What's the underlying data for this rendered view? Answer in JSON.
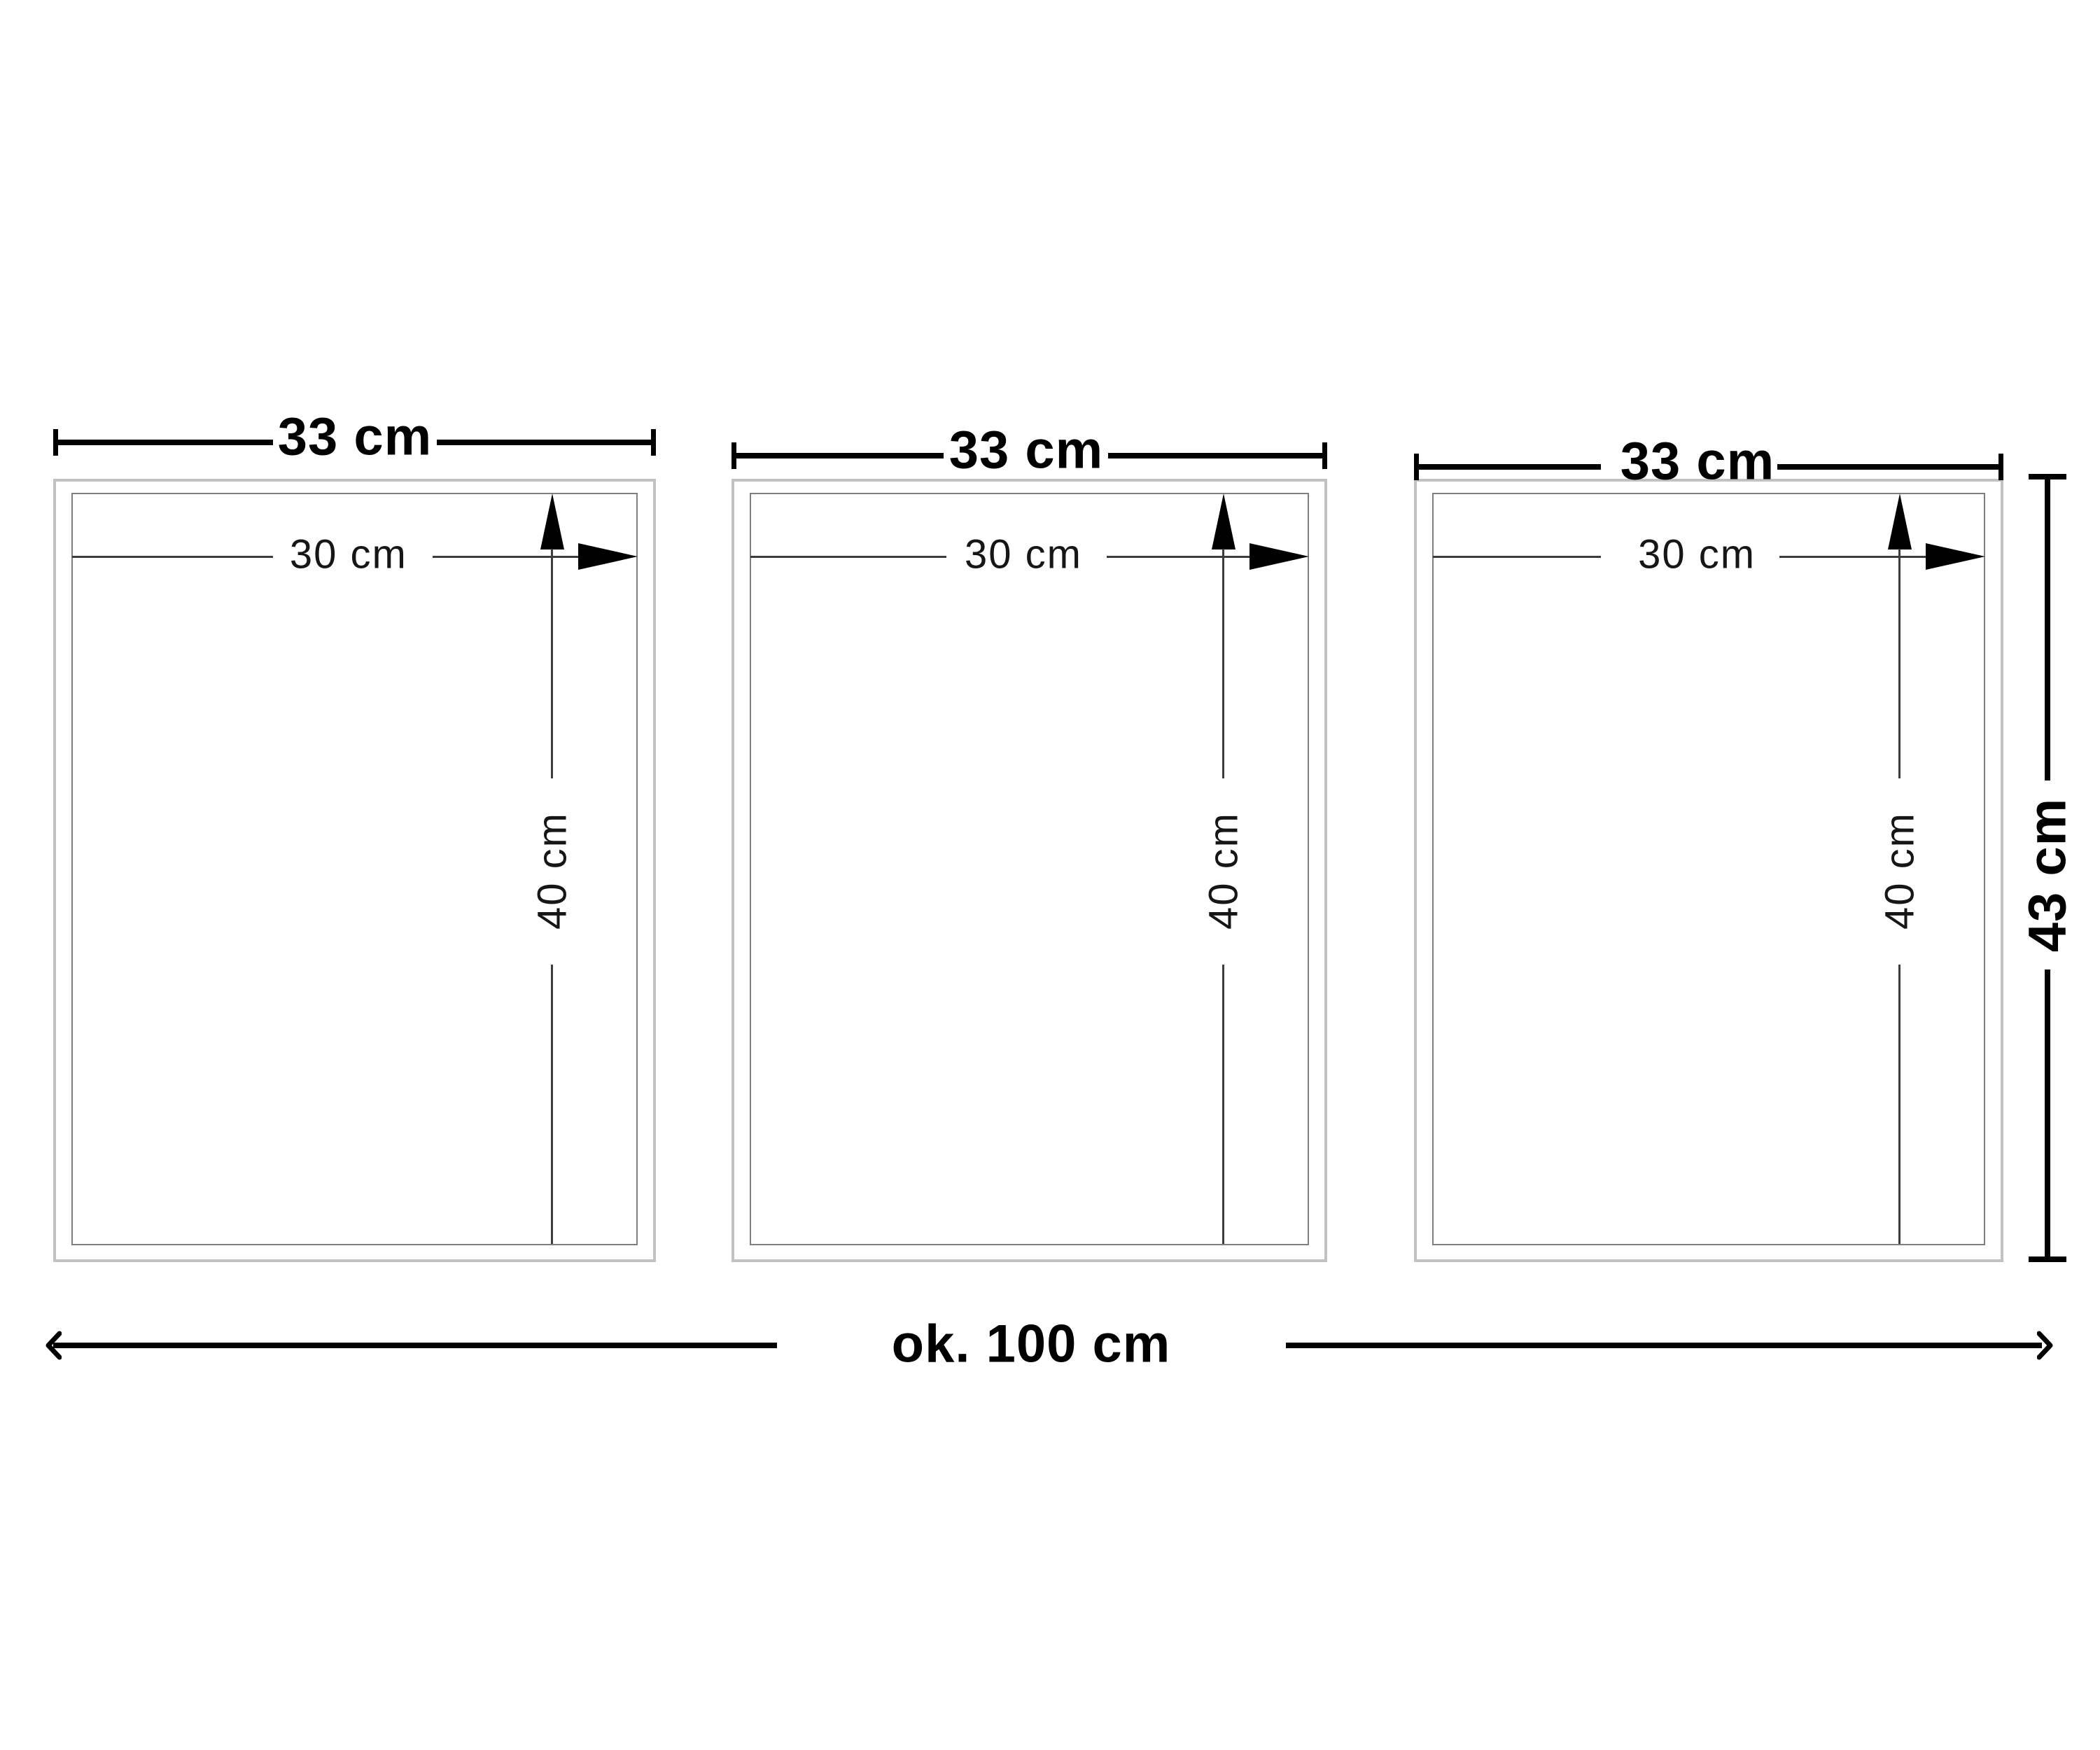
{
  "diagram": {
    "frames": [
      {
        "width_label": "33 cm",
        "picture_width_label": "30 cm",
        "picture_height_label": "40 cm"
      },
      {
        "width_label": "33 cm",
        "picture_width_label": "30 cm",
        "picture_height_label": "40 cm"
      },
      {
        "width_label": "33 cm",
        "picture_width_label": "30 cm",
        "picture_height_label": "40 cm"
      }
    ],
    "overall": {
      "width_label": "ok. 100 cm",
      "height_label": "43 cm"
    }
  },
  "icons": {
    "arrow_up": "▲",
    "arrow_right": "▶",
    "chevron_left": "‹",
    "chevron_right": "›"
  },
  "colors": {
    "frame_border": "#c2c2c2",
    "mat_border": "#7f7f7f",
    "dim_line": "#3d3d3d",
    "dim_black": "#000000",
    "background": "#ffffff",
    "text": "#000000"
  }
}
